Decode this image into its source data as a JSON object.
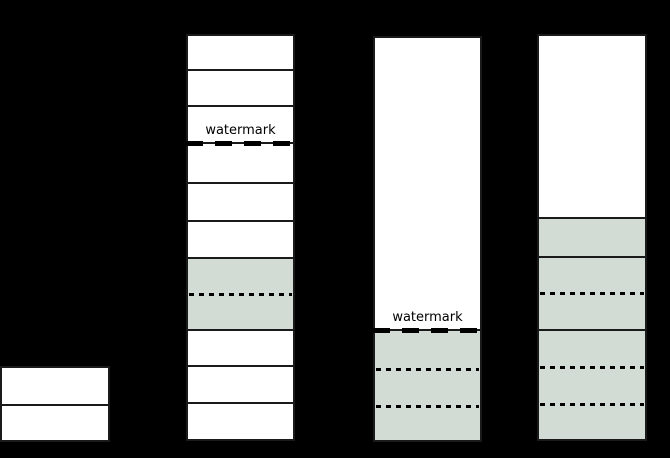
{
  "colors": {
    "background": "#000000",
    "box_fill": "#ffffff",
    "shaded_fill": "#d2dcd4",
    "border": "#1a1a1a",
    "line": "#000000"
  },
  "labels": {
    "watermark": "watermark"
  },
  "diagram": {
    "width": 670,
    "height": 458,
    "columns": [
      {
        "name": "bar-1",
        "x": 0,
        "top": 367,
        "width": 110,
        "segments": [
          {
            "fill": "box",
            "h": 38
          },
          {
            "fill": "box",
            "h": 36
          }
        ]
      },
      {
        "name": "bar-2",
        "x": 186,
        "top": 35,
        "width": 109,
        "segments": [
          {
            "fill": "box",
            "h": 35
          },
          {
            "fill": "box",
            "h": 36
          },
          {
            "fill": "box",
            "h": 37,
            "label": "watermark",
            "dashed_bottom": true
          },
          {
            "fill": "box",
            "h": 40
          },
          {
            "fill": "box",
            "h": 38
          },
          {
            "fill": "box",
            "h": 37
          },
          {
            "fill": "shaded",
            "h": 72,
            "dotted": [
              36
            ]
          },
          {
            "fill": "box",
            "h": 36
          },
          {
            "fill": "box",
            "h": 37
          },
          {
            "fill": "box",
            "h": 37
          }
        ]
      },
      {
        "name": "bar-3",
        "x": 373,
        "top": 37,
        "width": 109,
        "segments": [
          {
            "fill": "box",
            "h": 293,
            "label": "watermark",
            "dashed_bottom": true
          },
          {
            "fill": "shaded",
            "h": 111,
            "dotted": [
              39,
              76
            ]
          }
        ]
      },
      {
        "name": "bar-4",
        "x": 537,
        "top": 35,
        "width": 110,
        "segments": [
          {
            "fill": "box",
            "h": 183
          },
          {
            "fill": "shaded",
            "h": 39
          },
          {
            "fill": "shaded",
            "h": 73,
            "dotted": [
              36
            ]
          },
          {
            "fill": "shaded",
            "h": 110,
            "dotted": [
              37,
              74
            ]
          }
        ]
      }
    ]
  }
}
